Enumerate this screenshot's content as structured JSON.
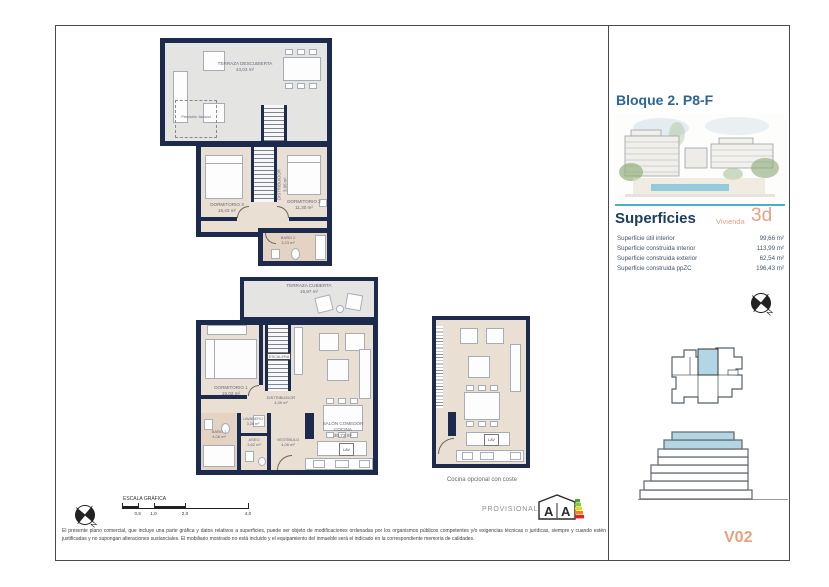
{
  "sheet": {
    "disclaimer": "El presente plano comercial, que incluye una parte gráfica y datos relativos a superficies, puede ser objeto de modificaciones ordenadas por los organismos públicos competentes y/o exigencias técnicas o jurídicas, siempre y cuando estén justificadas y no supongan alteraciones sustanciales. El mobiliario mostrado no está incluido y el equipamiento del inmueble será el indicado en la correspondiente memoria de calidades.",
    "provisional": "PROVISIONAL",
    "version": "V02",
    "energy_letter": "A"
  },
  "sidebar": {
    "title": "Bloque 2. P8-F",
    "superficies": {
      "title": "Superficies",
      "subtitle": "Vivienda",
      "type": "3d",
      "rows": [
        {
          "label": "Superficie útil interior",
          "value": "99,66 m²"
        },
        {
          "label": "Superficie construida interior",
          "value": "113,99 m²"
        },
        {
          "label": "Superficie construida exterior",
          "value": "62,54 m²"
        },
        {
          "label": "Superficie construida ppZC",
          "value": "196,43 m²"
        }
      ]
    }
  },
  "compass": {
    "n": "N"
  },
  "plans": {
    "roof": {
      "name": "TERRAZA DESCUBIERTA",
      "area": "43,03 m²",
      "jacuzzi": "Previsión Jacuzzi"
    },
    "upper": {
      "dormitorio3": {
        "name": "DORMITORIO 3",
        "area": "15,43 m²"
      },
      "dormitorio2": {
        "name": "DORMITORIO 2",
        "area": "11,30 m²"
      },
      "distribuidor": {
        "name": "DISTRIBUIDOR",
        "area": "3,96 m²"
      },
      "bano2": {
        "name": "BAÑO 2",
        "area": "3,23 m²"
      }
    },
    "main": {
      "terraza": {
        "name": "TERRAZA CUBIERTA",
        "area": "16,97 m²"
      },
      "dormitorio1": {
        "name": "DORMITORIO 1",
        "area": "15,02 m²"
      },
      "escalera": {
        "name": "ESCALERA"
      },
      "distribuidor": {
        "name": "DISTRIBUIDOR",
        "area": "4,39 m²"
      },
      "lavadero": {
        "name": "LAVADERO",
        "area": "3,28 m²"
      },
      "bano1": {
        "name": "BAÑO 1",
        "area": "4,08 m²"
      },
      "aseo": {
        "name": "ASEO",
        "area": "3,62 m²"
      },
      "vestibulo": {
        "name": "VESTÍBULO",
        "area": "4,06 m²"
      },
      "salon": {
        "name": "SALÓN COMEDOR COCINA",
        "area": "30,73 m²"
      },
      "lav": "LAV"
    },
    "optional": {
      "caption": "Cocina opcional con coste",
      "lav": "LAV"
    }
  },
  "scale": {
    "title": "ESCALA GRÁFICA",
    "ticks": [
      "0,5",
      "1,0",
      "2,0",
      "4,0"
    ]
  },
  "colors": {
    "wall": "#1c2b4d",
    "accent_teal": "#49b0c2",
    "accent_salmon": "#e6a183",
    "highlight": "#b3d6e4"
  }
}
